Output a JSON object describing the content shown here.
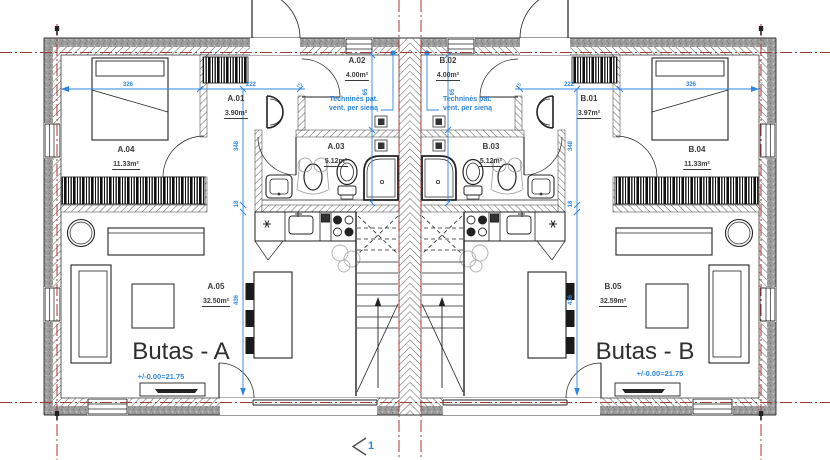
{
  "apartments": [
    {
      "name": "Butas - A",
      "level": "+/-0.00=21.75",
      "vent_note": [
        "Techninės pat.",
        "vent. per sieną"
      ],
      "rooms": [
        {
          "id": "A.01",
          "area": "3.90m²"
        },
        {
          "id": "A.02",
          "area": "4.00m²"
        },
        {
          "id": "A.03",
          "area": "5.12m²"
        },
        {
          "id": "A.04",
          "area": "11.33m²"
        },
        {
          "id": "A.05",
          "area": "32.50m²"
        }
      ]
    },
    {
      "name": "Butas - B",
      "level": "+/-0.00=21.75",
      "vent_note": [
        "Techninės pat.",
        "vent. per sieną"
      ],
      "rooms": [
        {
          "id": "B.01",
          "area": "3.97m²"
        },
        {
          "id": "B.02",
          "area": "4.00m²"
        },
        {
          "id": "B.03",
          "area": "5.12m²"
        },
        {
          "id": "B.04",
          "area": "11.33m²"
        },
        {
          "id": "B.05",
          "area": "32.59m²"
        }
      ]
    }
  ],
  "dimensions": {
    "bedroom_width": "326",
    "hall_width": "222",
    "hall_depth": "348",
    "wall": "18",
    "living_depth": "436",
    "duct": "65",
    "partition": "15"
  },
  "section_marker": "1",
  "colors": {
    "dimension_blue": "#2e86e0",
    "grid_red": "#9c3b33",
    "wall_gray": "#9d9d9d",
    "ink": "#3a3a3a"
  }
}
